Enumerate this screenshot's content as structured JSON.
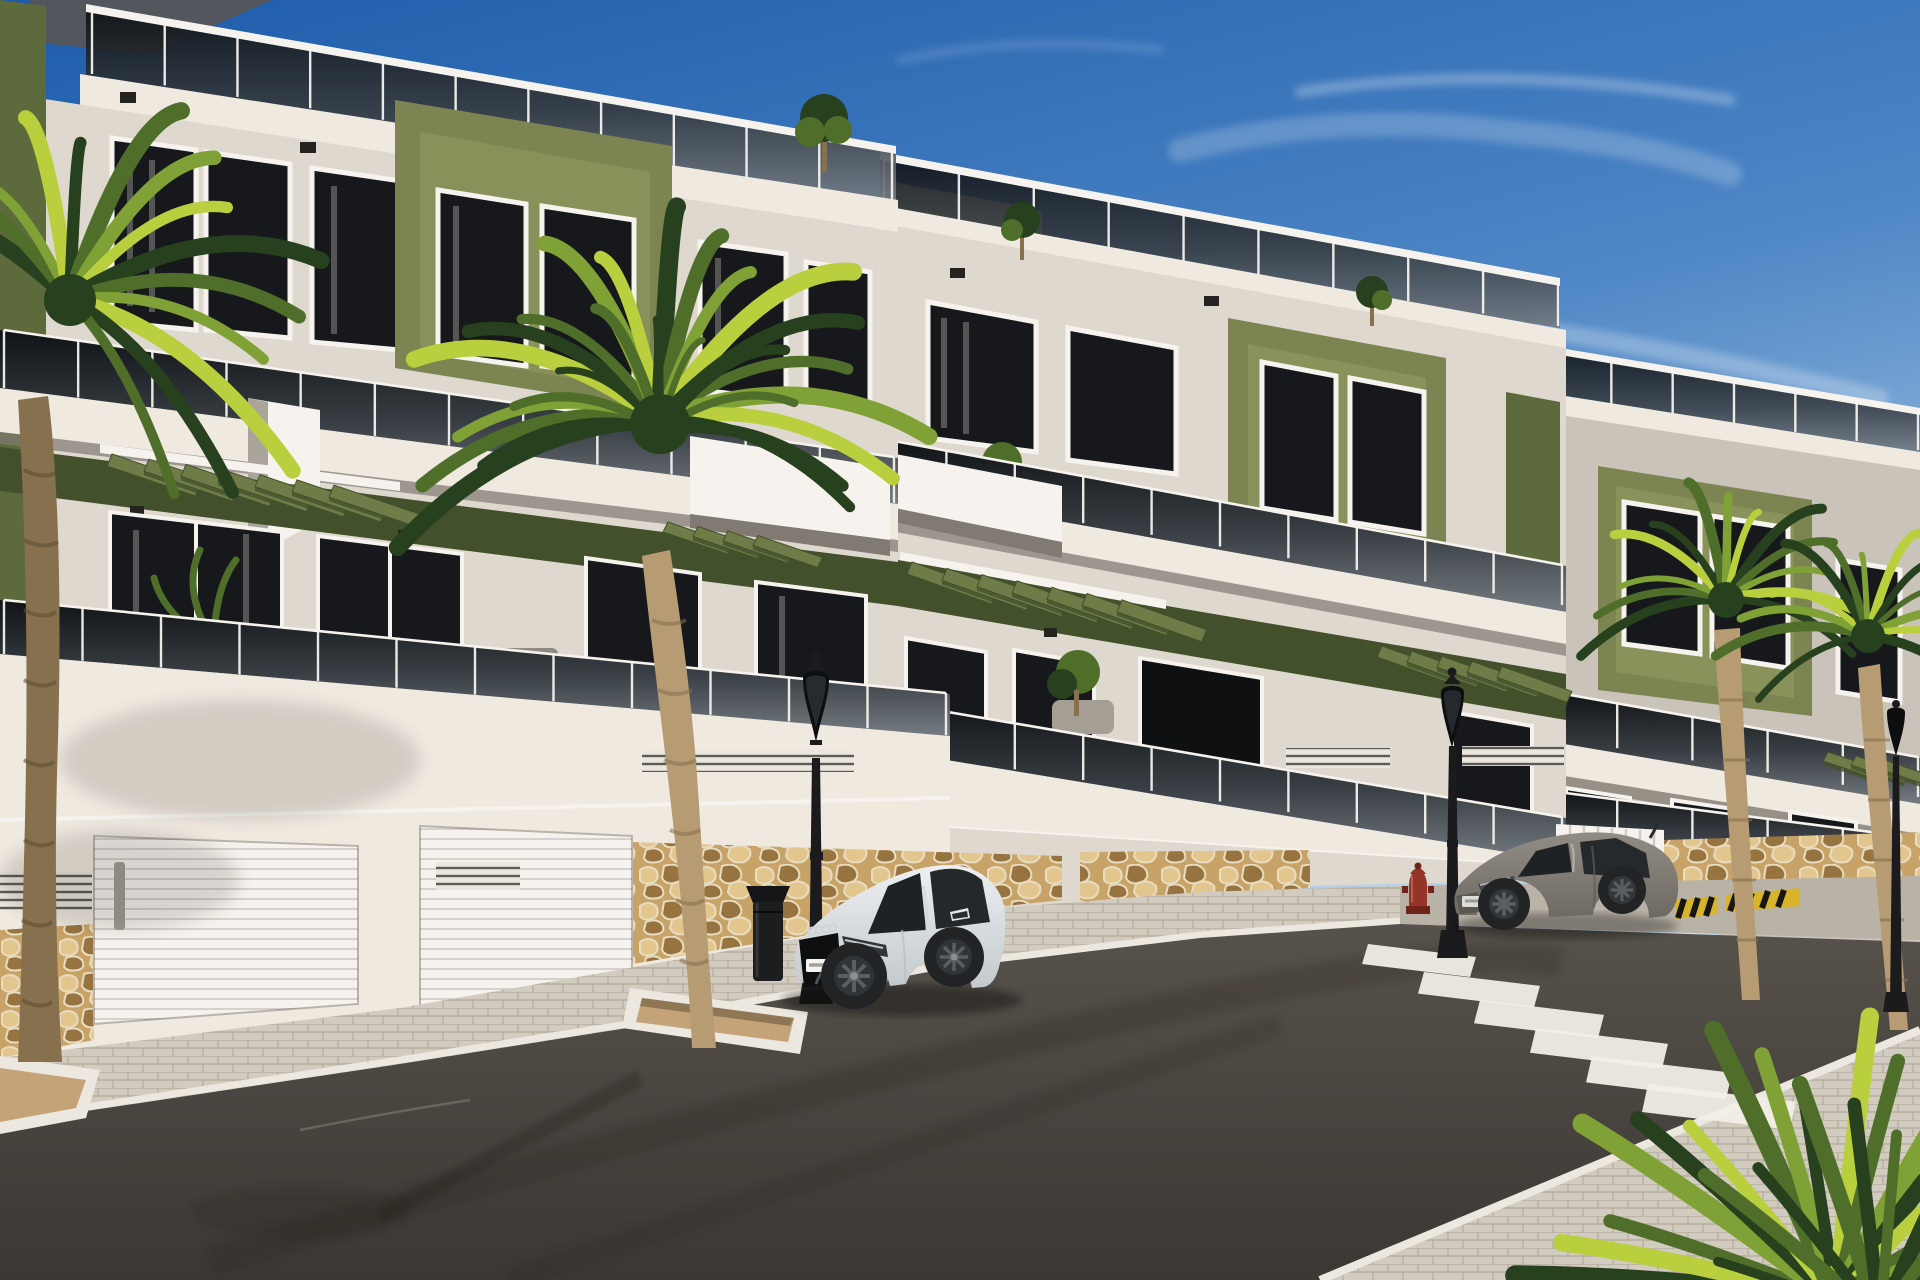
{
  "meta": {
    "title": "Street view render — white & olive apartment blocks",
    "description": "Sunny 3D architectural rendering of a row of three modern white apartment buildings with olive-green accent panels, glass balcony balustrades, green pergola slats, rooftop terraces with small trees, a stone-clad base with white garage doors, palm trees, two classic street lamps, a white coupe and a gray coupe parked on a dark asphalt street, a zebra crosswalk, a red fire hydrant, a black litter bin and a yellow-black hatched kerb marking."
  },
  "palette": {
    "sky-top": "#1d5cab",
    "sky-mid": "#4f87c6",
    "sky-low": "#a8c8e4",
    "sky-horizon": "#d9e6f1",
    "cloud": "#ffffff",
    "facade-sun": "#efe9e0",
    "facade-light": "#ded8cf",
    "facade-mid": "#c9c3ba",
    "facade-shadow": "#aaa49b",
    "facade-deep": "#807a72",
    "trim-white": "#f6f3ee",
    "olive": "#7c8551",
    "olive-light": "#97a065",
    "olive-dark": "#5c6a3c",
    "olive-deep": "#42512c",
    "olive-slat": "#6f7c47",
    "glass-dark": "#101316",
    "glass-mid": "#393f44",
    "glass-light": "#747b81",
    "win-dark": "#16181c",
    "curtain": "#8b8882",
    "stone-base": "#c8a368",
    "stone-light": "#e3c68e",
    "stone-dark": "#97743f",
    "mortar": "#e8dcc0",
    "swalk-sun": "#d2cbbf",
    "swalk-shade": "#b9b2a6",
    "curb": "#ece8df",
    "road-light": "#57524b",
    "road-dark": "#3b3733",
    "gravel": "#c4a379",
    "palm-dark": "#27401d",
    "palm-mid": "#4e6e2a",
    "palm-light": "#7fa135",
    "palm-bright": "#b9cf3e",
    "trunk": "#b79c73",
    "trunk-dark": "#86704e",
    "metal-black": "#1b1b1d",
    "hydrant-red": "#953528",
    "warn-yellow": "#d7b42a",
    "car-white": "#edeff0",
    "car-white-shade": "#c3c9cd",
    "car-glass": "#1e2225",
    "wheel": "#212325",
    "rim": "#595e62",
    "car-gray": "#918c84",
    "car-gray-shade": "#6e6a63"
  },
  "scene": {
    "buildings": [
      {
        "label": "left apartment block",
        "floors_visible": 2,
        "accents": "olive green boxes, glass balustrades, roof terrace railing"
      },
      {
        "label": "middle apartment block",
        "floors_visible": 2,
        "accents": "olive band, pergola slats, roof terrace railing"
      },
      {
        "label": "right apartment block",
        "floors_visible": 2,
        "accents": "olive box, glass balustrades"
      }
    ],
    "street": {
      "lamps": 3,
      "crosswalk_stripes": 6,
      "garage_doors": 3,
      "planters": 2,
      "litter_bin": 1,
      "fire_hydrant": 1,
      "hazard_kerb_marking": 1
    },
    "vehicles": [
      {
        "label": "white coupe",
        "position": "parked center-left"
      },
      {
        "label": "gray coupe",
        "position": "parked center-right near crosswalk"
      }
    ],
    "vegetation": {
      "foreground_palms": 2,
      "background_palms": 2,
      "corner_palm_bush": 1,
      "rooftop_trees": 3,
      "balcony_plants": 5
    }
  }
}
